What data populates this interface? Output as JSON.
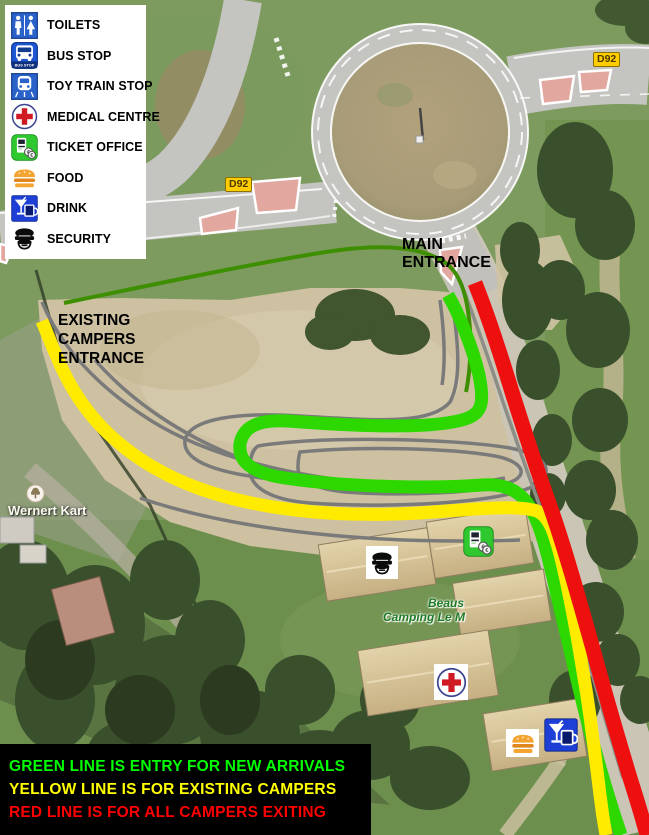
{
  "legend": {
    "items": [
      {
        "label": "TOILETS",
        "icon": "toilets-icon"
      },
      {
        "label": "BUS STOP",
        "icon": "bus-stop-icon",
        "icon_caption": "BUS STOP"
      },
      {
        "label": "TOY TRAIN STOP",
        "icon": "toy-train-icon"
      },
      {
        "label": "MEDICAL CENTRE",
        "icon": "medical-icon"
      },
      {
        "label": "TICKET OFFICE",
        "icon": "ticket-office-icon"
      },
      {
        "label": "FOOD",
        "icon": "food-icon"
      },
      {
        "label": "DRINK",
        "icon": "drink-icon"
      },
      {
        "label": "SECURITY",
        "icon": "security-icon"
      }
    ]
  },
  "annotations": {
    "main_entrance": "MAIN ENTRANCE",
    "existing_campers_entrance": "EXISTING CAMPERS ENTRANCE"
  },
  "road_badges": {
    "d92_west": "D92",
    "d92_east": "D92"
  },
  "map_labels": {
    "wernert_kart": "Wernert Kart",
    "camping_line1": "Beaus",
    "camping_line2": "Camping Le M"
  },
  "routes": {
    "new_arrivals": {
      "color": "#2cd800"
    },
    "existing_campers": {
      "color": "#ffeb00"
    },
    "exiting": {
      "color": "#ee0f0f"
    },
    "approach": {
      "color": "#3e8f00"
    }
  },
  "info_box": {
    "lines": [
      {
        "text": "GREEN LINE IS ENTRY FOR NEW ARRIVALS",
        "color": "#00ff00"
      },
      {
        "text": "YELLOW LINE IS FOR EXISTING CAMPERS",
        "color": "#ffff00"
      },
      {
        "text": "RED LINE IS FOR ALL CAMPERS EXITING",
        "color": "#ff0000"
      }
    ]
  }
}
